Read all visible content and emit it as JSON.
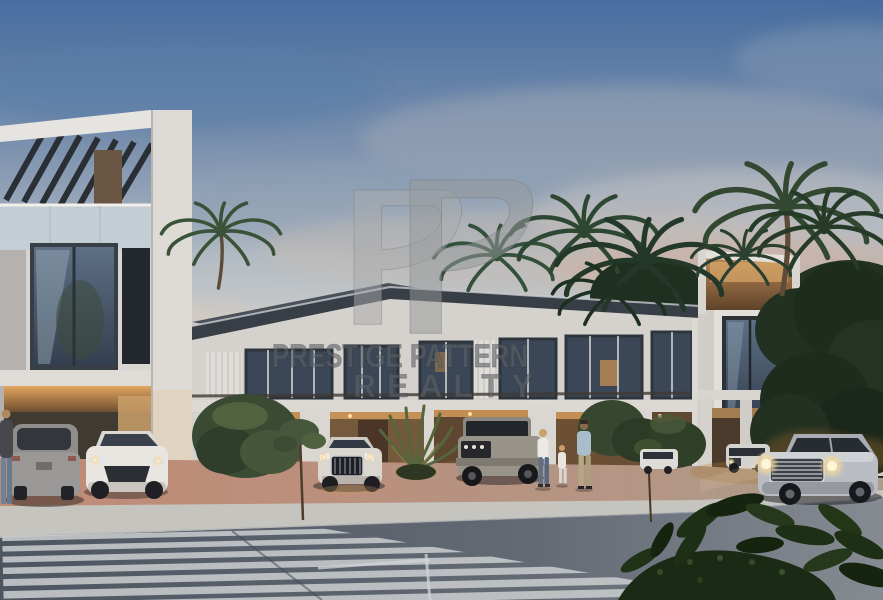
{
  "scene_meta": {
    "kind": "architectural-rendering-photo",
    "subject": "modern two-storey townhouse community at dusk",
    "visible_elements": [
      "townhouses",
      "rooftop pergola",
      "palm trees",
      "parked cars",
      "silver suv driving",
      "family walking",
      "crosswalk",
      "foreground plants"
    ]
  },
  "watermark": {
    "logo_monogram": "PP",
    "line1": "PRESTIGE PATTERN",
    "line2": "REALTY"
  },
  "palette": {
    "sky_top": "#476da0",
    "sky_horizon": "#d6d4cf",
    "cloud_pink": "#cfae9c",
    "wall_light": "#d9d6d2",
    "roof_fascia": "#383e46",
    "window_glass": "#46566a",
    "warm_light": "#e2a65f",
    "carport_interior": "#6b5035",
    "foliage_dark": "#1e2c1d",
    "palm_green": "#2e4733",
    "pavement_pink": "#c08a75",
    "sidewalk": "#c6c4be",
    "road": "#555d68",
    "watermark_gray": "#9a9da0"
  }
}
